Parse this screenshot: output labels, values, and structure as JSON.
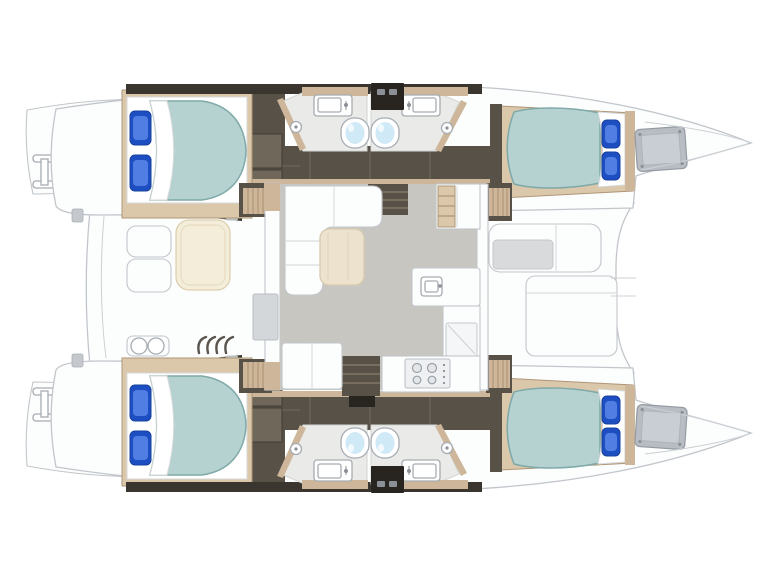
{
  "diagram": {
    "subject": "catamaran yacht deck floor plan, top view, bow to the right",
    "regions": [
      "swim-platform-port",
      "swim-platform-starboard",
      "aft-cabin-port",
      "fwd-cabin-port",
      "aft-bathroom-port",
      "fwd-bathroom-port",
      "aft-cabin-starboard",
      "fwd-cabin-starboard",
      "aft-bathroom-starboard",
      "fwd-bathroom-starboard",
      "aft-cockpit",
      "salon",
      "galley",
      "fwd-cockpit",
      "forepeak-port",
      "forepeak-starboard"
    ],
    "counts": {
      "cabins": 4,
      "bathrooms": 4,
      "toilets": 4,
      "sinks": 4,
      "showers": 4,
      "double-beds": 4,
      "cockpits": 2
    }
  },
  "colors": {
    "outline": "#c2c6cb",
    "deck": "#fcfdfd",
    "deckShade": "#f1f3f4",
    "walnut": "#575148",
    "walnutDark": "#3a352e",
    "walnutDarker": "#282420",
    "walnutLight": "#6f6759",
    "tan": "#cdb69a",
    "tanDark": "#af9677",
    "tanLight": "#dbc8ab",
    "mattress": "#b5d2d0",
    "mattressEdge": "#7fa9a8",
    "pillow": "#1e4fc2",
    "pillowLight": "#5b86e8",
    "salonFloor": "#c8c6c1",
    "bathFloor": "#eaebe9",
    "water": "#cfe9f7",
    "cream": "#f3edda",
    "creamEdge": "#ddd0b0",
    "cushion": "#d9dadc",
    "hatch": "#b7bdc3",
    "fixture": "#a6acb1",
    "steel": "#c5c9ce",
    "treadLine": "#8a7f6d"
  }
}
